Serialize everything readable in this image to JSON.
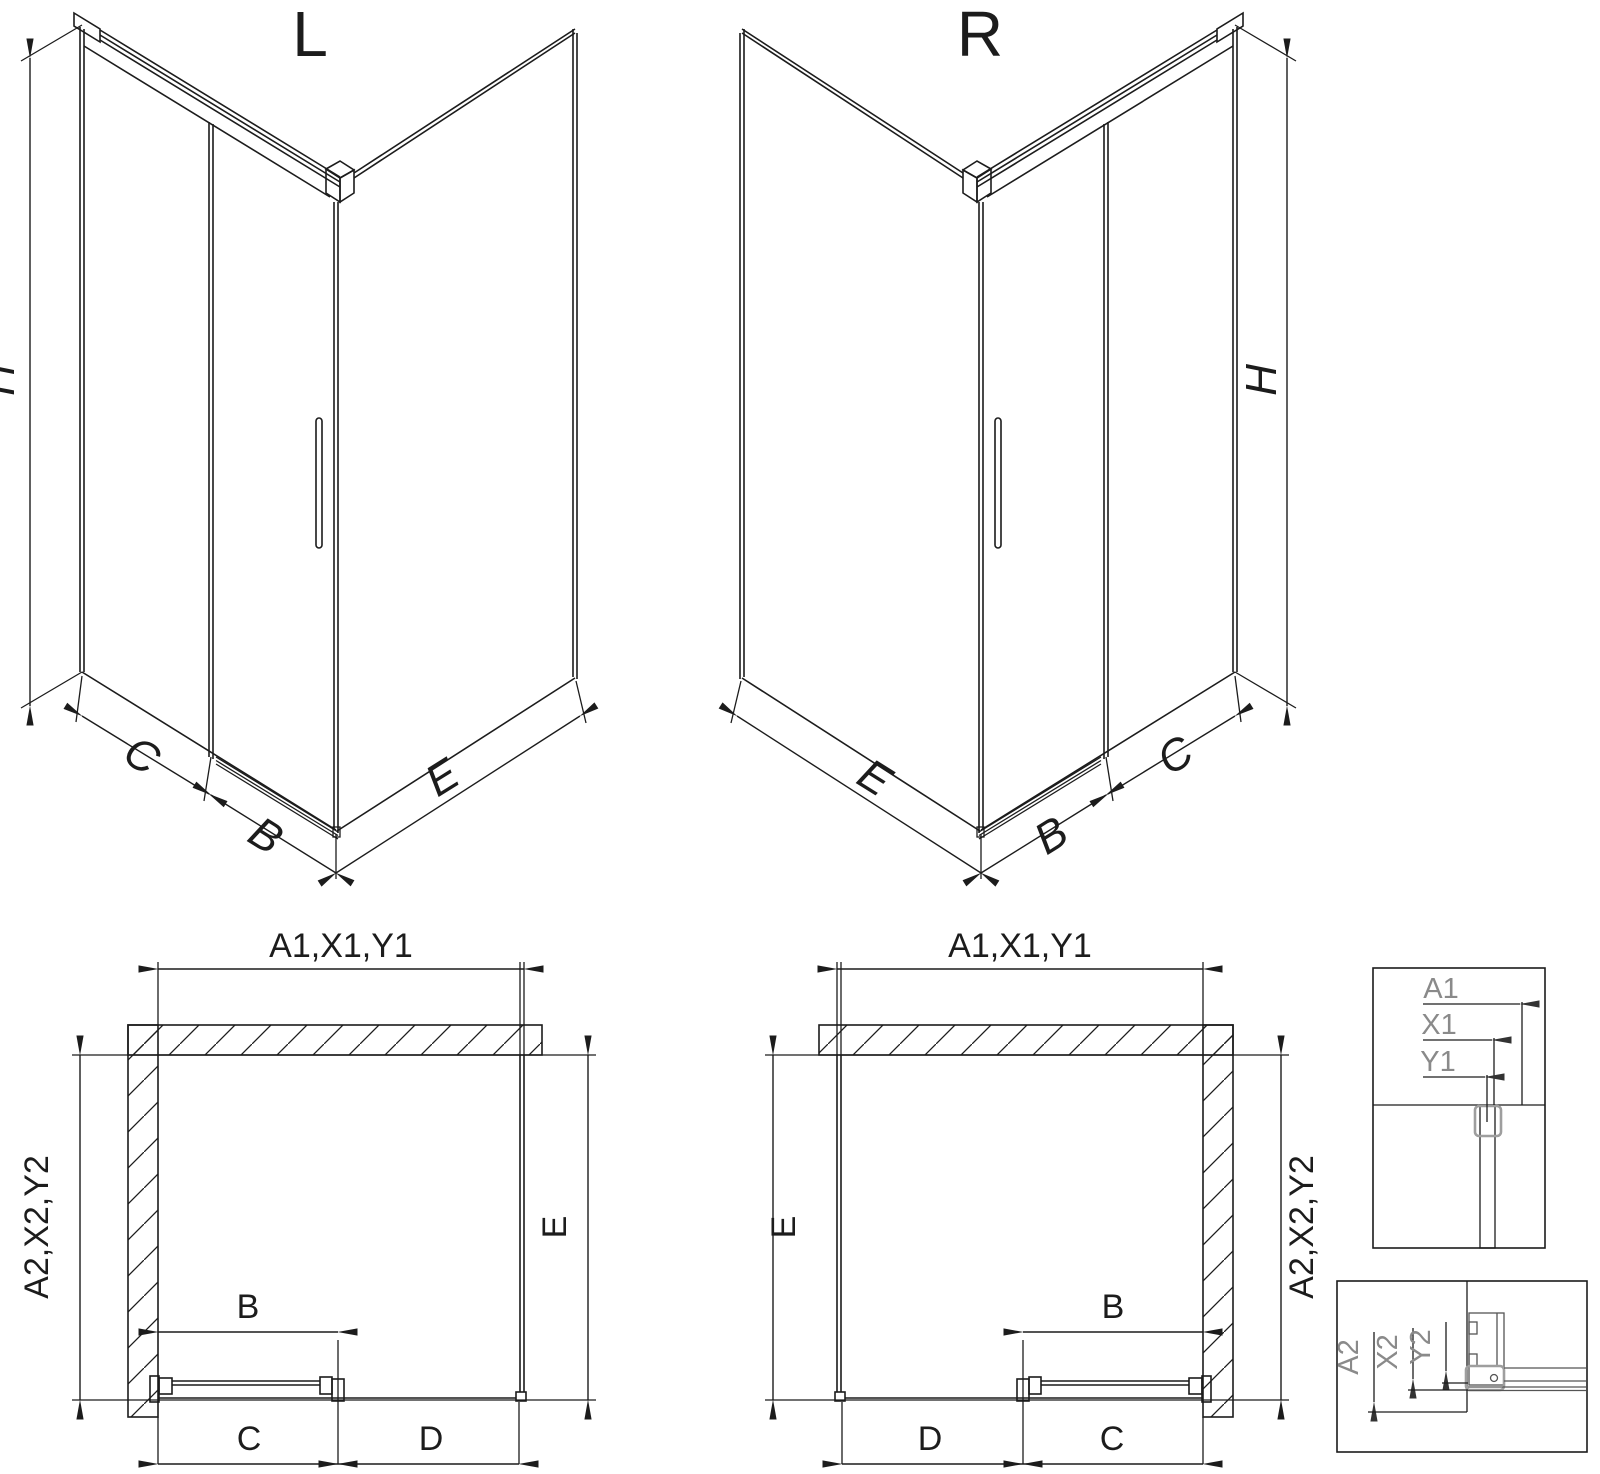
{
  "colors": {
    "line": "#1c1c1c",
    "label_gray": "#8a8a8a",
    "clamp_gray": "#9e9e9e",
    "background": "#ffffff"
  },
  "iso_left": {
    "title": "L",
    "height_dim": "H",
    "fixed_panel_dim": "C",
    "door_dim": "B",
    "side_panel_dim": "E"
  },
  "iso_right": {
    "title": "R",
    "height_dim": "H",
    "side_panel_dim": "E",
    "door_dim": "B",
    "fixed_panel_dim": "C"
  },
  "plan_left": {
    "top_dim": "A1,X1,Y1",
    "left_dim": "A2,X2,Y2",
    "side_dim": "E",
    "door_dim": "B",
    "bottom_left_dim": "C",
    "bottom_right_dim": "D"
  },
  "plan_right": {
    "top_dim": "A1,X1,Y1",
    "right_dim": "A2,X2,Y2",
    "side_dim": "E",
    "door_dim": "B",
    "bottom_left_dim": "D",
    "bottom_right_dim": "C"
  },
  "detail_top": {
    "labels": [
      "A1",
      "X1",
      "Y1"
    ]
  },
  "detail_bottom": {
    "labels": [
      "A2",
      "X2",
      "Y2"
    ]
  }
}
